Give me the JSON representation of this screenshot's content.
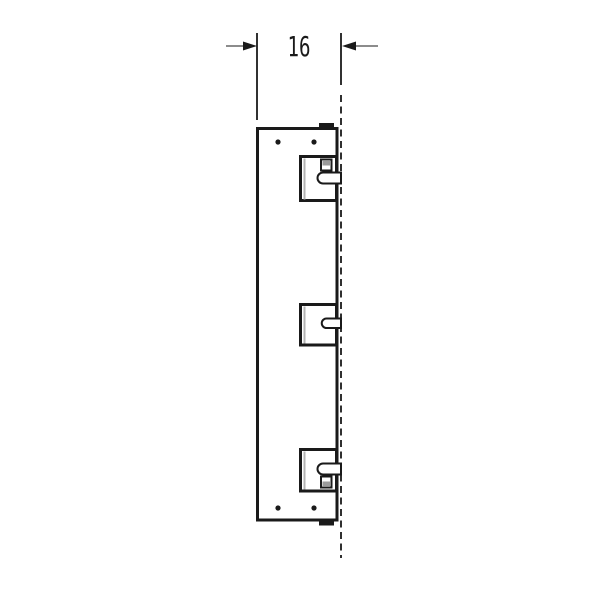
{
  "drawing": {
    "type": "technical-side-view",
    "dimension": {
      "label": "16"
    },
    "colors": {
      "line": "#1a1a1a",
      "dimension_tail": "#8c8c8c",
      "shading": "#b3b3b3",
      "background": "#ffffff"
    }
  }
}
